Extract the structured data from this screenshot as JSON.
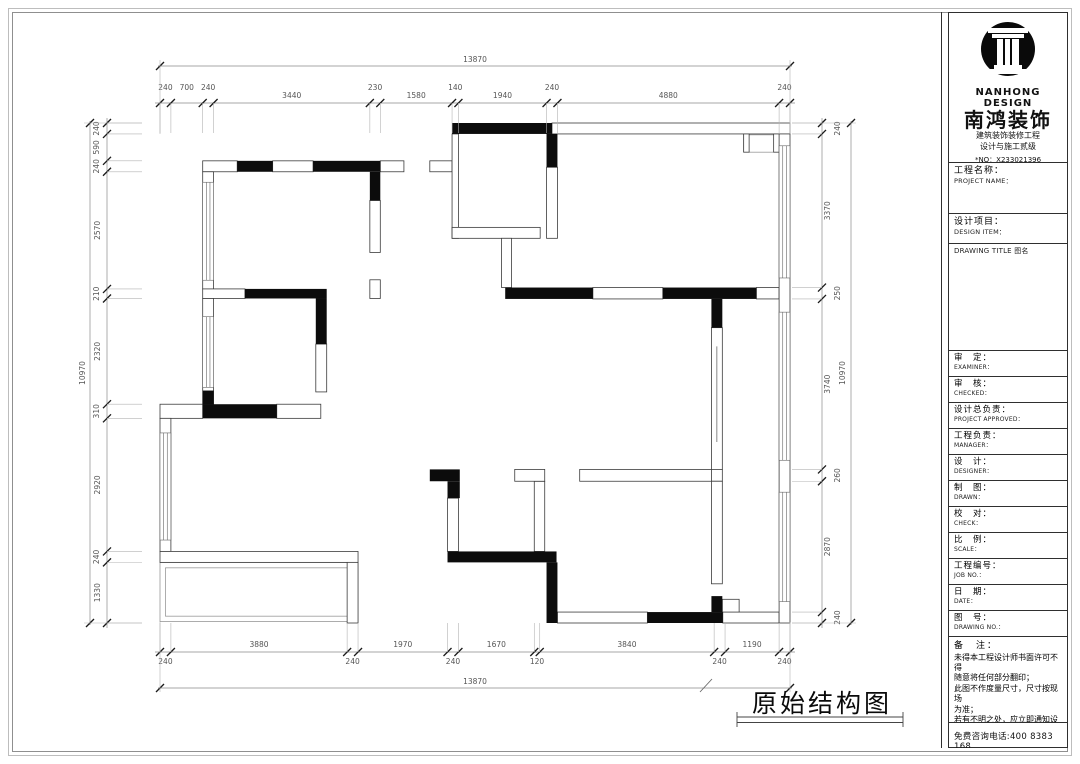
{
  "drawing_title": {
    "text": "原始结构图"
  },
  "title_block": {
    "logo": {
      "brand_en": "NANHONG DESIGN",
      "brand_cn": "南鸿装饰",
      "cert_line1": "建筑装饰装修工程",
      "cert_line2": "设计与施工贰级",
      "cert_no": "*NO：X233021396"
    },
    "project_name": {
      "cn": "工程名称：",
      "en": "PROJECT NAME："
    },
    "design_item": {
      "cn": "设计项目：",
      "en": "DESIGN ITEM："
    },
    "drawing_title_label": "DRAWING TITLE 图名",
    "rows": [
      {
        "cn": "审　定：",
        "en": "EXAMINER："
      },
      {
        "cn": "审　核：",
        "en": "CHECKED："
      },
      {
        "cn": "设计总负责：",
        "en": "PROJECT APPROVED："
      },
      {
        "cn": "工程负责：",
        "en": "MANAGER："
      },
      {
        "cn": "设　计：",
        "en": "DESIGNER："
      },
      {
        "cn": "制　图：",
        "en": "DRAWN："
      },
      {
        "cn": "校　对：",
        "en": "CHECK："
      },
      {
        "cn": "比　例：",
        "en": "SCALE："
      },
      {
        "cn": "工程编号：",
        "en": "JOB NO.："
      },
      {
        "cn": "日　期：",
        "en": "DATE："
      },
      {
        "cn": "图　号：",
        "en": "DRAWING NO.："
      }
    ],
    "notes": {
      "label": "备　注：",
      "lines": [
        "未得本工程设计师书面许可不得",
        "随意将任何部分翻印；",
        "此图不作度量尺寸，尺寸按现场",
        "为准；",
        "若有不明之处，应立即通知设计",
        "师。"
      ],
      "fine_print": "本设计解释权归设计师所有。"
    },
    "phone": "免费咨询电话:400 8383 168"
  },
  "dimensions": {
    "top": {
      "total": "13870",
      "segments": [
        "240",
        "700",
        "240",
        "3440",
        "230",
        "1580",
        "140",
        "1940",
        "240",
        "4880",
        "240"
      ]
    },
    "bottom": {
      "total": "13870",
      "segments": [
        "240",
        "3880",
        "240",
        "1970",
        "240",
        "1670",
        "120",
        "3840",
        "240",
        "1190",
        "240"
      ]
    },
    "left": {
      "total": "10970",
      "segments": [
        "240",
        "590",
        "240",
        "2570",
        "210",
        "2320",
        "310",
        "2920",
        "240",
        "1330"
      ]
    },
    "right": {
      "total": "10970",
      "segments": [
        "240",
        "3370",
        "250",
        "3740",
        "260",
        "2870",
        "240"
      ]
    }
  },
  "plan": {
    "extent_mm": {
      "width": 13870,
      "height": 10970
    },
    "white_walls": [
      [
        8630,
        0,
        5240,
        240
      ],
      [
        940,
        830,
        760,
        240
      ],
      [
        2480,
        830,
        890,
        240
      ],
      [
        4850,
        830,
        520,
        240
      ],
      [
        5940,
        830,
        490,
        240
      ],
      [
        6430,
        240,
        140,
        2290
      ],
      [
        6430,
        2290,
        1940,
        240
      ],
      [
        8510,
        970,
        240,
        1560
      ],
      [
        4620,
        1700,
        230,
        1140
      ],
      [
        4620,
        3440,
        230,
        410
      ],
      [
        940,
        1070,
        240,
        2570
      ],
      [
        940,
        3640,
        930,
        210
      ],
      [
        940,
        3850,
        240,
        2320
      ],
      [
        3430,
        4850,
        240,
        1050
      ],
      [
        0,
        6170,
        940,
        310
      ],
      [
        2570,
        6170,
        970,
        310
      ],
      [
        0,
        6480,
        240,
        2920
      ],
      [
        0,
        9400,
        4360,
        240
      ],
      [
        4120,
        9640,
        240,
        1330
      ],
      [
        6330,
        8230,
        240,
        1170
      ],
      [
        8240,
        7860,
        230,
        1540
      ],
      [
        8750,
        10730,
        1980,
        240
      ],
      [
        12390,
        10730,
        1240,
        240
      ],
      [
        7810,
        7600,
        660,
        260
      ],
      [
        9240,
        7600,
        2900,
        260
      ],
      [
        9530,
        3610,
        1540,
        250
      ],
      [
        13130,
        3610,
        500,
        250
      ],
      [
        12140,
        4490,
        240,
        3110
      ],
      [
        12140,
        7600,
        240,
        260
      ],
      [
        12140,
        7860,
        240,
        2250
      ],
      [
        13630,
        240,
        240,
        10730
      ],
      [
        7520,
        2530,
        220,
        1080
      ],
      [
        12380,
        10450,
        370,
        280
      ],
      [
        12850,
        240,
        120,
        400
      ],
      [
        13510,
        240,
        120,
        400
      ]
    ],
    "black_walls": [
      [
        6430,
        0,
        2200,
        240
      ],
      [
        1700,
        830,
        780,
        240
      ],
      [
        3370,
        830,
        1480,
        240
      ],
      [
        4620,
        1070,
        230,
        630
      ],
      [
        1870,
        3640,
        1800,
        210
      ],
      [
        3430,
        3850,
        240,
        1000
      ],
      [
        7600,
        3610,
        1930,
        250
      ],
      [
        11070,
        3610,
        2060,
        250
      ],
      [
        12140,
        3860,
        240,
        630
      ],
      [
        940,
        5870,
        240,
        300
      ],
      [
        940,
        6170,
        1630,
        310
      ],
      [
        5940,
        7600,
        660,
        260
      ],
      [
        6330,
        7860,
        270,
        370
      ],
      [
        6330,
        9400,
        2400,
        240
      ],
      [
        8510,
        9640,
        240,
        1330
      ],
      [
        10730,
        10730,
        1660,
        240
      ],
      [
        12140,
        10380,
        240,
        350
      ],
      [
        8510,
        240,
        240,
        730
      ]
    ],
    "windows": [
      [
        940,
        1300,
        240,
        2150
      ],
      [
        940,
        4250,
        240,
        1550
      ],
      [
        0,
        6800,
        240,
        2350
      ],
      [
        13630,
        500,
        240,
        2900
      ],
      [
        13630,
        4150,
        240,
        3250
      ],
      [
        13630,
        8100,
        240,
        2400
      ]
    ],
    "thin_rects": [
      [
        0,
        9640,
        4360,
        1300
      ],
      [
        120,
        9760,
        4120,
        1060
      ],
      [
        12850,
        260,
        780,
        380
      ]
    ],
    "slits": [
      [
        12260,
        4900,
        12260,
        7000
      ]
    ]
  }
}
